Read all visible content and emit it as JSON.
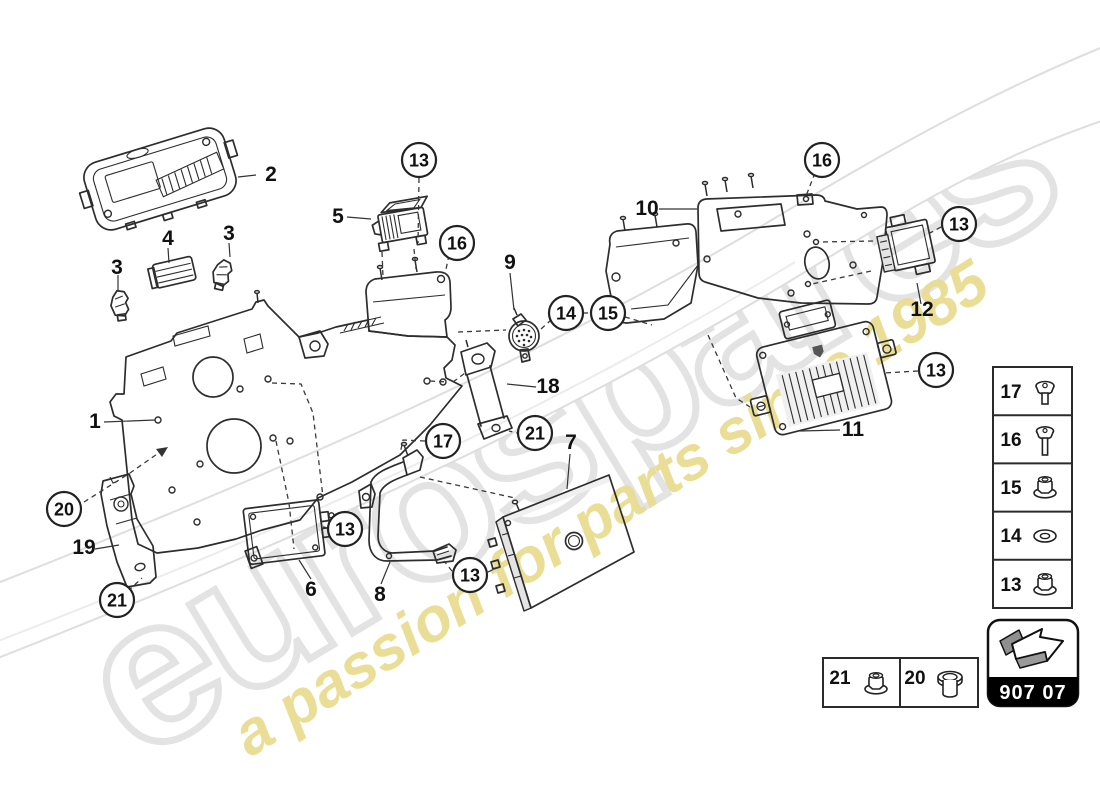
{
  "watermark": {
    "brand": "eurospares",
    "tagline": "a passion for parts since 1985"
  },
  "diagram": {
    "labels": {
      "p1": "1",
      "p2": "2",
      "p3a": "3",
      "p3b": "3",
      "p4": "4",
      "p5": "5",
      "p6": "6",
      "p7": "7",
      "p8": "8",
      "p9": "9",
      "p10": "10",
      "p11": "11",
      "p12": "12",
      "p18": "18",
      "p19": "19"
    },
    "callouts": {
      "c13": "13",
      "c14": "14",
      "c15": "15",
      "c16": "16",
      "c17": "17",
      "c20": "20",
      "c21": "21"
    }
  },
  "legend": {
    "rows": [
      {
        "num": "17",
        "icon": "pan-head-screw"
      },
      {
        "num": "16",
        "icon": "long-screw"
      },
      {
        "num": "15",
        "icon": "flange-nut"
      },
      {
        "num": "14",
        "icon": "washer"
      },
      {
        "num": "13",
        "icon": "flange-nut"
      }
    ]
  },
  "hardware_box": {
    "cells": [
      {
        "num": "21",
        "icon": "flange-nut"
      },
      {
        "num": "20",
        "icon": "bushing"
      }
    ]
  },
  "footer": {
    "group_code": "907 07"
  },
  "colors": {
    "line": "#2d2d2d",
    "watermark_gray": "#e3e3e3",
    "tagline_yellow": "#e9dd92"
  }
}
